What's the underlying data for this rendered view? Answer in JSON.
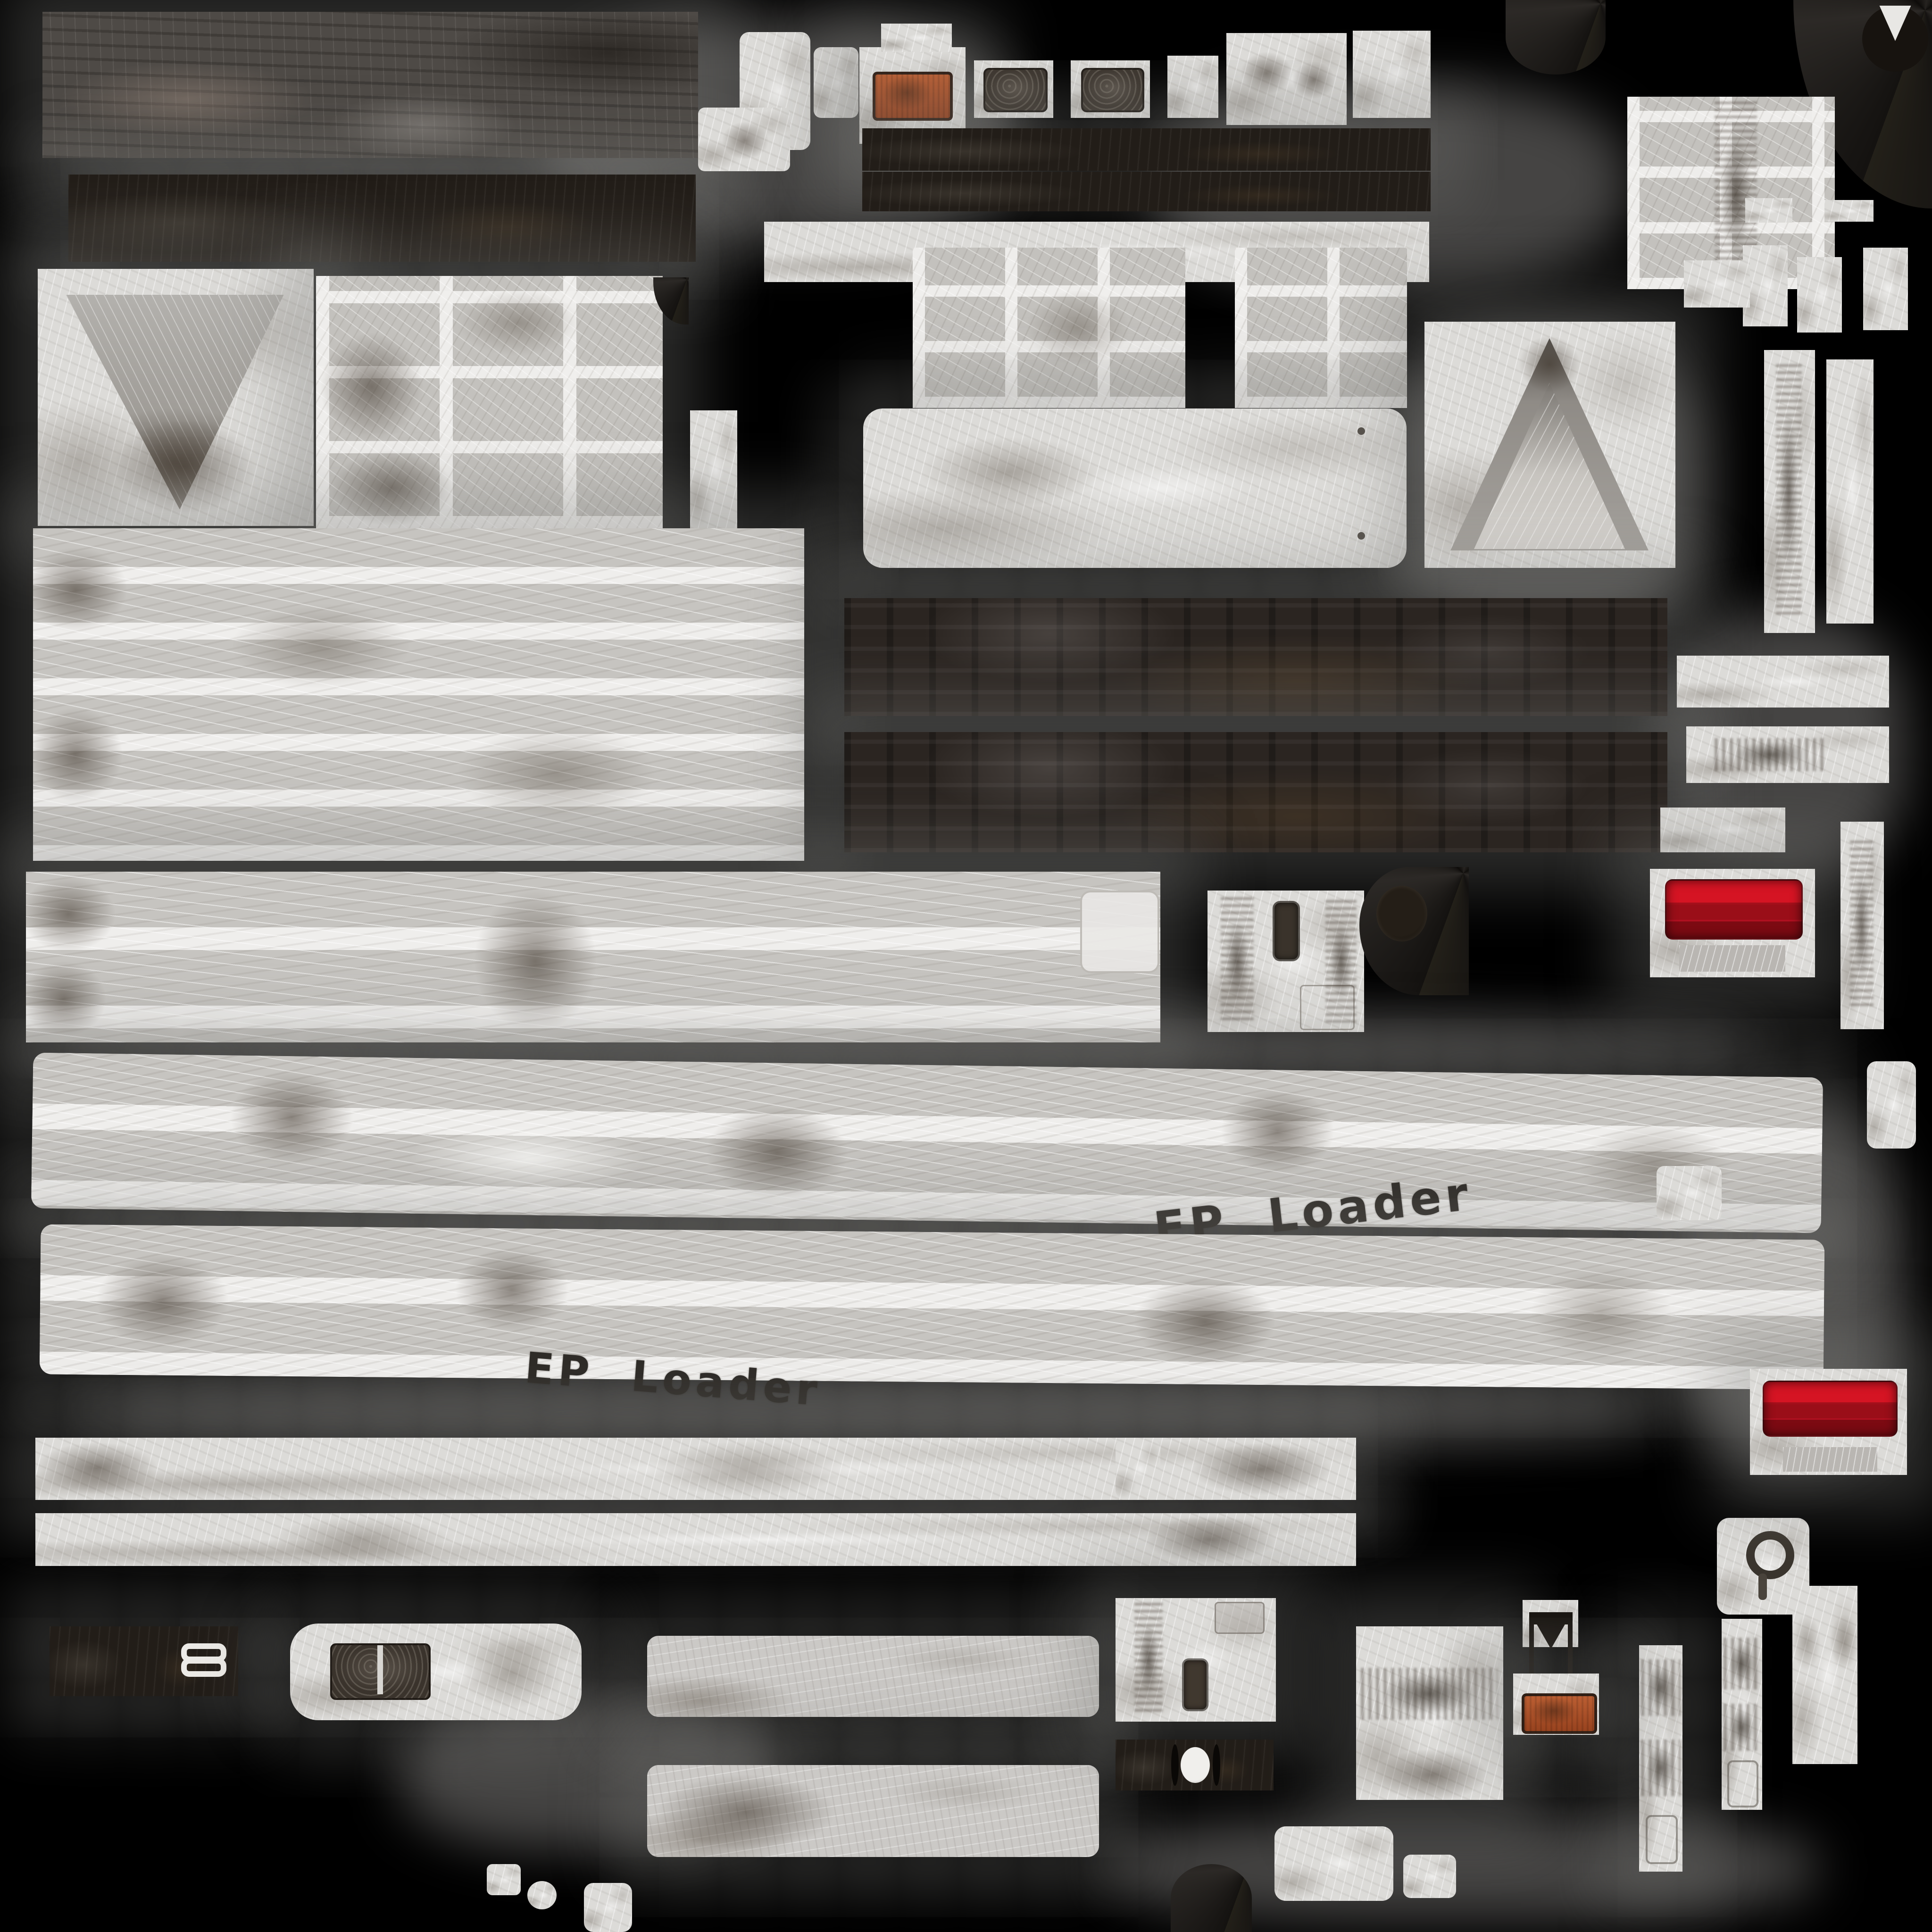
{
  "background_color": "#000000",
  "decals": {
    "ep_loader_right": "EP  Loader",
    "ep_loader_left": "EP  Loader",
    "ink_color": "#2e2b27"
  },
  "icons": {
    "stencil_mark": "double-rounded-rectangle-stencil",
    "v_notch": "v-notch-cutout",
    "hub_ring": "hub-ring-cutout"
  },
  "colors": {
    "background": "#000000",
    "padding_gray": "#7d7c7a",
    "panel_white": "#dcdbd8",
    "panel_light": "#efeeec",
    "panel_gray": "#c3c1bd",
    "stripe_gray": "#c6c4c0",
    "slate": "#4e4a46",
    "black_steel": "#221d18",
    "dark_bar": "#2b2521",
    "grime_brown": "#4a4036",
    "tail_light_red_bright": "#d51423",
    "tail_light_red_dark": "#8e0c15",
    "reflector_orange": "#a8512a",
    "decal_ink": "#2e2b27",
    "stencil_white": "#eceae6"
  },
  "patches": [
    {
      "name": "weathered-slate-panel-top-left"
    },
    {
      "name": "black-steel-strip-top-left"
    },
    {
      "name": "funnel-v-patch"
    },
    {
      "name": "grid-panel-large"
    },
    {
      "name": "striped-deck-large"
    },
    {
      "name": "reflector-orange-top"
    },
    {
      "name": "mudflap-inset-patch-a"
    },
    {
      "name": "mudflap-inset-patch-b"
    },
    {
      "name": "dark-chassis-strip-1"
    },
    {
      "name": "dark-chassis-strip-2"
    },
    {
      "name": "mid-grid-panel-1"
    },
    {
      "name": "mid-grid-panel-2"
    },
    {
      "name": "rounded-hood-panel"
    },
    {
      "name": "gable-tent-patch"
    },
    {
      "name": "scuffed-panel-block-right"
    },
    {
      "name": "dark-chassis-slab-1"
    },
    {
      "name": "dark-chassis-slab-2"
    },
    {
      "name": "long-panel-band"
    },
    {
      "name": "door-inset-panel"
    },
    {
      "name": "hub-wedge"
    },
    {
      "name": "tail-light-upper"
    },
    {
      "name": "tail-light-lower"
    },
    {
      "name": "fender-band-upper"
    },
    {
      "name": "fender-band-lower"
    },
    {
      "name": "sill-strip-1"
    },
    {
      "name": "sill-strip-2"
    },
    {
      "name": "stencil-plate-black"
    },
    {
      "name": "rounded-step-plate"
    },
    {
      "name": "floor-panel-1"
    },
    {
      "name": "floor-panel-2"
    },
    {
      "name": "cab-back-panel"
    },
    {
      "name": "axle-bar"
    },
    {
      "name": "side-post-panel"
    },
    {
      "name": "upright-strip-1"
    },
    {
      "name": "upright-strip-2"
    },
    {
      "name": "upright-strip-3"
    },
    {
      "name": "u-bracket"
    },
    {
      "name": "reflector-orange-bottom"
    },
    {
      "name": "hub-ring-patch"
    },
    {
      "name": "curved-counterweight-panel"
    }
  ]
}
